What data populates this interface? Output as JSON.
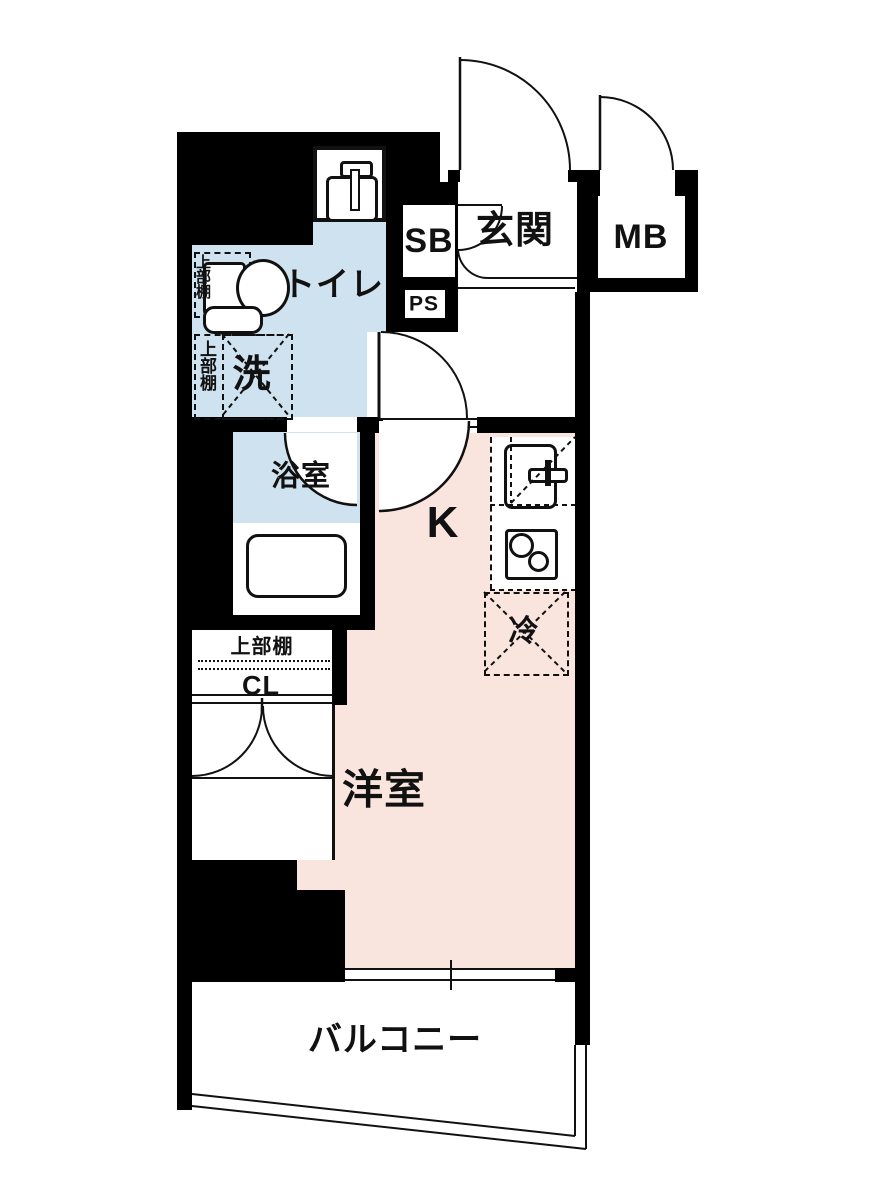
{
  "floorplan": {
    "colors": {
      "wall": "#000000",
      "wet_room_fill": "#cfe2ef",
      "main_room_fill": "#fae4de",
      "floor": "#ffffff",
      "line": "#111111"
    },
    "labels": {
      "entrance": "玄関",
      "meter_box": "MB",
      "shoe_box": "SB",
      "pipe_space": "PS",
      "toilet": "トイレ",
      "upper_shelf_toilet": "上部棚",
      "washer": "洗",
      "upper_shelf_washer": "上部棚",
      "bathroom": "浴室",
      "kitchen": "K",
      "fridge": "冷",
      "upper_shelf_closet": "上部棚",
      "closet": "CL",
      "western_room": "洋室",
      "balcony": "バルコニー"
    }
  }
}
